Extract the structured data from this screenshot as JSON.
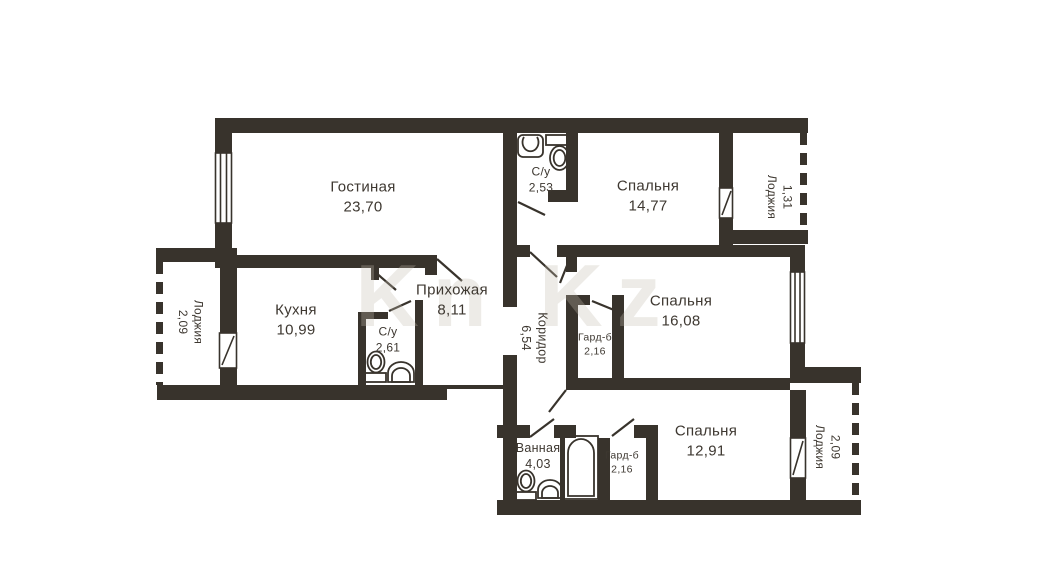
{
  "plan": {
    "title": "apartment-floor-plan",
    "watermark": "Kn Kz",
    "colors": {
      "wall": "#38332c",
      "text": "#3e3831",
      "background": "#ffffff"
    },
    "fixtures": [
      "toilet-icon",
      "sink-icon",
      "bathtub-icon"
    ],
    "rooms": [
      {
        "name": "Гостиная",
        "area": "23,70"
      },
      {
        "name": "Кухня",
        "area": "10,99"
      },
      {
        "name": "Прихожая",
        "area": "8,11"
      },
      {
        "name": "С/у",
        "area": "2,61"
      },
      {
        "name": "С/у",
        "area": "2,53"
      },
      {
        "name": "Коридор",
        "area": "6,54"
      },
      {
        "name": "Спальня",
        "area": "14,77"
      },
      {
        "name": "Спальня",
        "area": "16,08"
      },
      {
        "name": "Спальня",
        "area": "12,91"
      },
      {
        "name": "Гард-б",
        "area": "2,16"
      },
      {
        "name": "Гард-б",
        "area": "2,16"
      },
      {
        "name": "Ванная",
        "area": "4,03"
      },
      {
        "name": "Лоджия",
        "area": "2,09"
      },
      {
        "name": "Лоджия",
        "area": "1,31"
      },
      {
        "name": "Лоджия",
        "area": "2,09"
      }
    ]
  }
}
